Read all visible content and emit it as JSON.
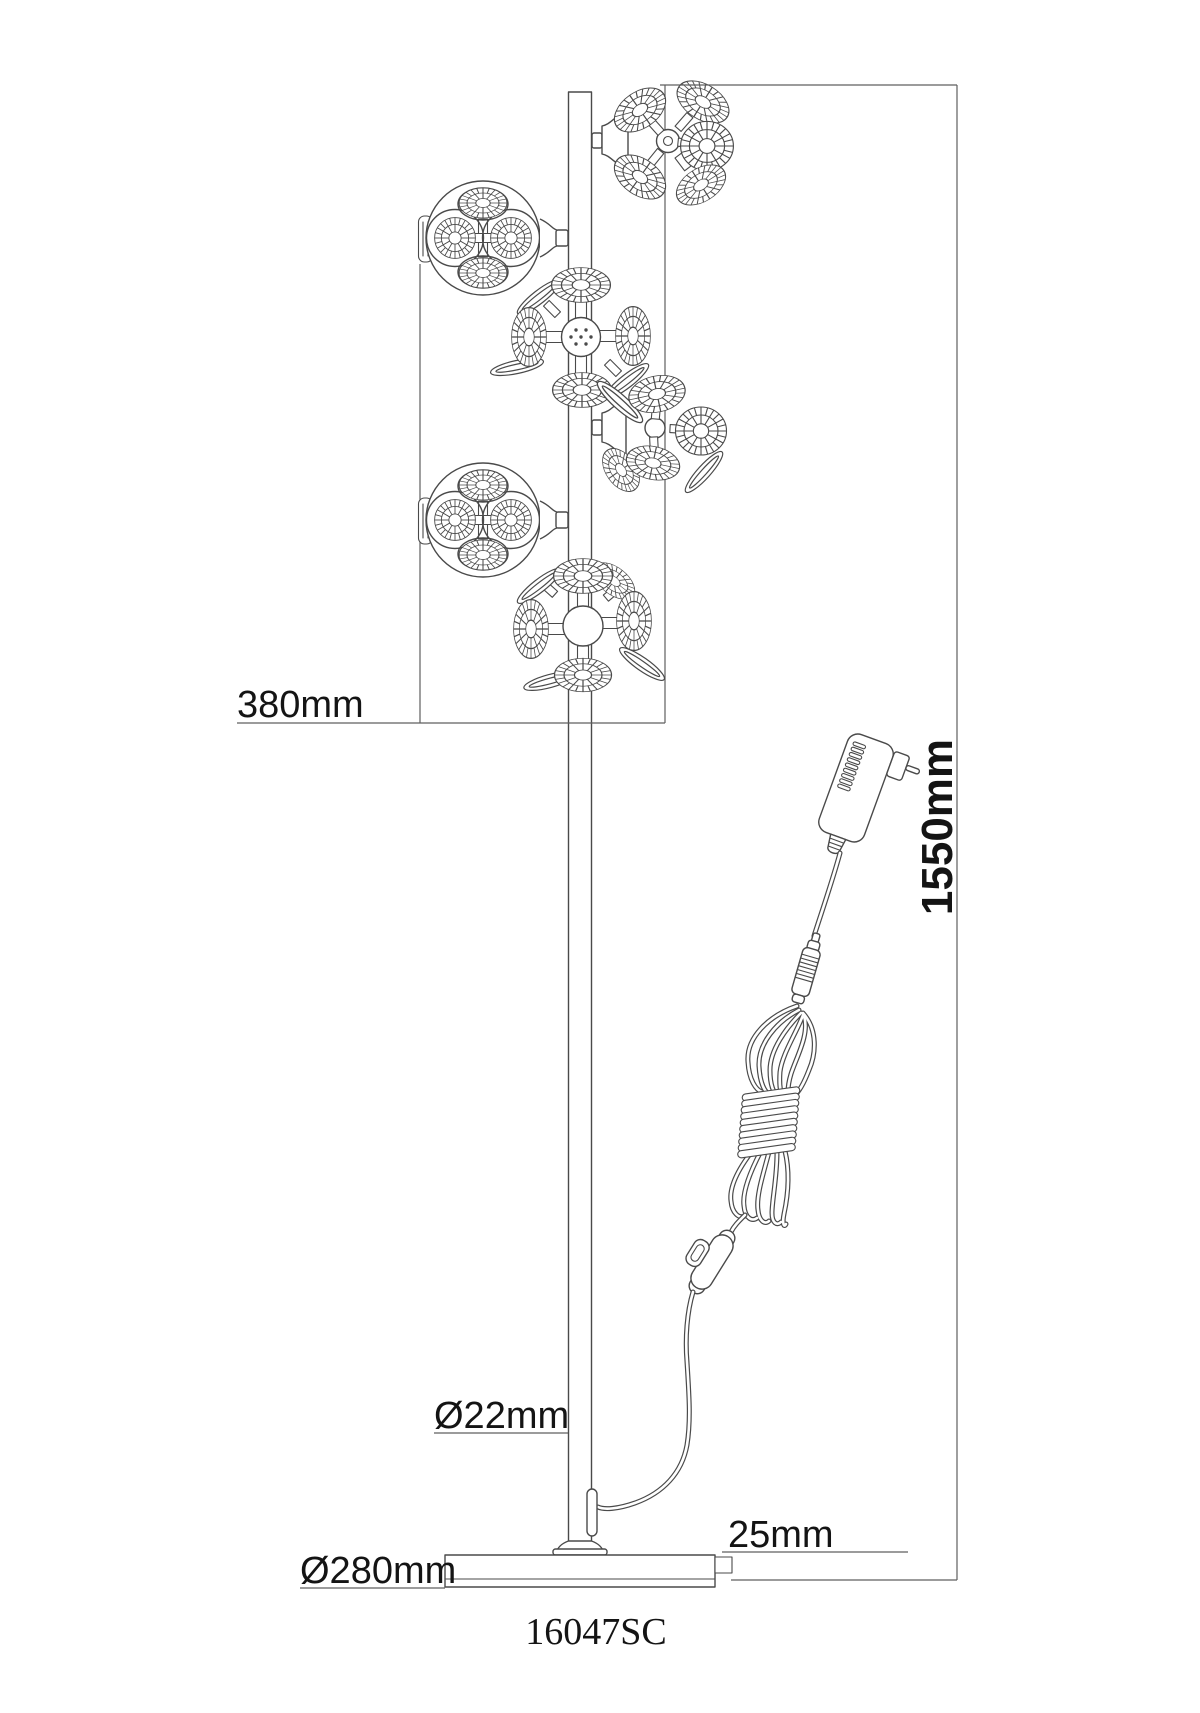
{
  "drawing": {
    "model_number": "16047SC",
    "dimensions": {
      "head_cluster_width": "380mm",
      "total_height": "1550mm",
      "pole_diameter": "Ø22mm",
      "base_diameter": "Ø280mm",
      "base_height": "25mm"
    },
    "colors": {
      "line": "#4a4a4a",
      "text": "#141414",
      "background": "#ffffff"
    }
  }
}
